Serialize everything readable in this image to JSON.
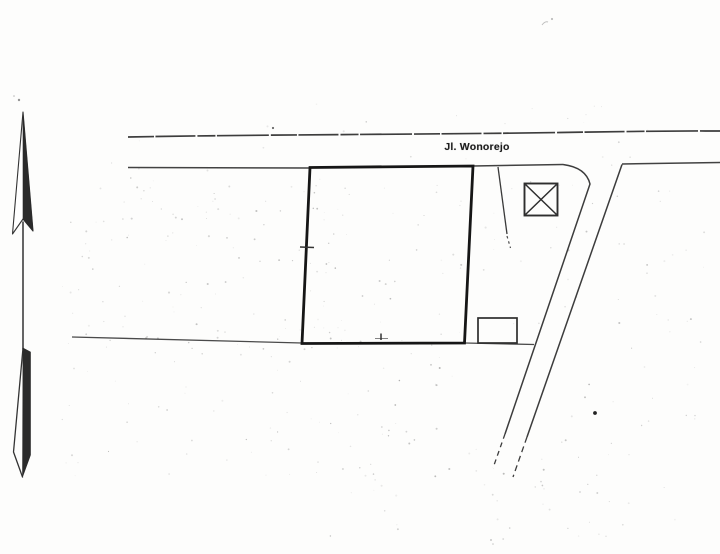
{
  "map": {
    "road_label": "Jl. Wonorejo",
    "symbols": {
      "north_arrow": "north-arrow",
      "crossed_square": "crossed-square-marker",
      "main_plot": "bold-parcel-outline",
      "small_rectangle": "small-structure-outline"
    },
    "colors": {
      "ink": "#2a2a2a",
      "bold_outline": "#151515",
      "paper": "#fdfdfc"
    }
  }
}
